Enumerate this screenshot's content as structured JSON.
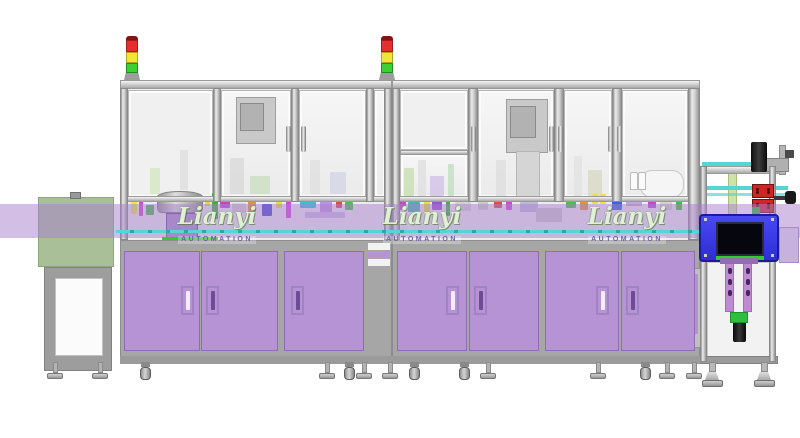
{
  "scene": {
    "title": "Automated assembly line - CAD side elevation"
  },
  "watermark": {
    "brand": "Lianyi",
    "subtitle": "AUTOMATION"
  },
  "colors": {
    "band": "rgba(167,128,205,0.5)",
    "cabinetDoor": "#b593d4",
    "cabinetDoorBorder": "#8f6cb4",
    "handleSlotDark": "#6f4b96",
    "handleSlotLight": "#f4ecfa",
    "panel": "#f0f0f0",
    "green_box": "#a8bf98",
    "tower_red": "#e63030",
    "tower_yellow": "#f2e437",
    "tower_green": "#3ecf35",
    "button_red": "#ee2222",
    "blue_box": "#3a3aee",
    "conveyor_cyan": "#55d6d2",
    "bright_green": "#2ecc2e",
    "cabinet_base": "#a6a6a6"
  },
  "signal_towers": [
    {
      "x": 126
    },
    {
      "x": 381
    }
  ],
  "parts": [
    {
      "x": 150,
      "y": 168,
      "w": 10,
      "h": 26,
      "c": "#d8e8c8"
    },
    {
      "x": 180,
      "y": 150,
      "w": 8,
      "h": 40,
      "c": "#e0e0e0"
    },
    {
      "x": 230,
      "y": 158,
      "w": 14,
      "h": 36,
      "c": "#dcdcdc"
    },
    {
      "x": 250,
      "y": 176,
      "w": 20,
      "h": 18,
      "c": "#d0e0c8"
    },
    {
      "x": 310,
      "y": 160,
      "w": 10,
      "h": 34,
      "c": "#e2e2e2"
    },
    {
      "x": 330,
      "y": 172,
      "w": 16,
      "h": 22,
      "c": "#d8d8e8"
    },
    {
      "x": 131,
      "y": 200,
      "w": 6,
      "h": 14,
      "c": "#e8e840"
    },
    {
      "x": 139,
      "y": 196,
      "w": 4,
      "h": 20,
      "c": "#d040d0"
    },
    {
      "x": 146,
      "y": 205,
      "w": 8,
      "h": 10,
      "c": "#40b840"
    },
    {
      "x": 205,
      "y": 196,
      "w": 5,
      "h": 10,
      "c": "#e0e020"
    },
    {
      "x": 212,
      "y": 193,
      "w": 6,
      "h": 26,
      "c": "#30b030"
    },
    {
      "x": 220,
      "y": 200,
      "w": 10,
      "h": 8,
      "c": "#c040c0"
    },
    {
      "x": 232,
      "y": 203,
      "w": 14,
      "h": 10,
      "c": "#d0d0d0"
    },
    {
      "x": 248,
      "y": 198,
      "w": 8,
      "h": 14,
      "c": "#e09030"
    },
    {
      "x": 258,
      "y": 196,
      "w": 26,
      "h": 6,
      "c": "#b0b0e8"
    },
    {
      "x": 262,
      "y": 204,
      "w": 10,
      "h": 12,
      "c": "#4040d0"
    },
    {
      "x": 276,
      "y": 200,
      "w": 6,
      "h": 8,
      "c": "#e8e030"
    },
    {
      "x": 286,
      "y": 196,
      "w": 5,
      "h": 22,
      "c": "#d040d0"
    },
    {
      "x": 300,
      "y": 198,
      "w": 16,
      "h": 10,
      "c": "#30c0c0"
    },
    {
      "x": 320,
      "y": 200,
      "w": 12,
      "h": 14,
      "c": "#b890d8"
    },
    {
      "x": 305,
      "y": 212,
      "w": 40,
      "h": 6,
      "c": "#c8b8e0"
    },
    {
      "x": 336,
      "y": 196,
      "w": 6,
      "h": 12,
      "c": "#e04040"
    },
    {
      "x": 345,
      "y": 202,
      "w": 8,
      "h": 8,
      "c": "#40c040"
    },
    {
      "x": 404,
      "y": 168,
      "w": 10,
      "h": 28,
      "c": "#cde2b8"
    },
    {
      "x": 418,
      "y": 160,
      "w": 8,
      "h": 36,
      "c": "#e2e2e2"
    },
    {
      "x": 430,
      "y": 176,
      "w": 14,
      "h": 20,
      "c": "#d4c8e8"
    },
    {
      "x": 448,
      "y": 164,
      "w": 6,
      "h": 32,
      "c": "#c8e0c8"
    },
    {
      "x": 496,
      "y": 160,
      "w": 10,
      "h": 36,
      "c": "#e0e0e0"
    },
    {
      "x": 574,
      "y": 156,
      "w": 8,
      "h": 40,
      "c": "#e4e4e4"
    },
    {
      "x": 588,
      "y": 170,
      "w": 14,
      "h": 26,
      "c": "#dcdccc"
    },
    {
      "x": 398,
      "y": 198,
      "w": 8,
      "h": 12,
      "c": "#c040c0"
    },
    {
      "x": 408,
      "y": 202,
      "w": 12,
      "h": 10,
      "c": "#40b0b0"
    },
    {
      "x": 424,
      "y": 196,
      "w": 6,
      "h": 16,
      "c": "#e0e030"
    },
    {
      "x": 432,
      "y": 200,
      "w": 10,
      "h": 10,
      "c": "#9050c0"
    },
    {
      "x": 446,
      "y": 196,
      "w": 4,
      "h": 20,
      "c": "#30b030"
    },
    {
      "x": 455,
      "y": 202,
      "w": 16,
      "h": 9,
      "c": "#d0d0d0"
    },
    {
      "x": 478,
      "y": 198,
      "w": 10,
      "h": 12,
      "c": "#c8c8c8"
    },
    {
      "x": 494,
      "y": 200,
      "w": 8,
      "h": 8,
      "c": "#e04040"
    },
    {
      "x": 506,
      "y": 196,
      "w": 6,
      "h": 14,
      "c": "#d040d0"
    },
    {
      "x": 520,
      "y": 202,
      "w": 18,
      "h": 10,
      "c": "#b8b8d8"
    },
    {
      "x": 536,
      "y": 208,
      "w": 26,
      "h": 14,
      "c": "#c6c6c6"
    },
    {
      "x": 566,
      "y": 198,
      "w": 10,
      "h": 10,
      "c": "#40c040"
    },
    {
      "x": 580,
      "y": 196,
      "w": 8,
      "h": 14,
      "c": "#e09030"
    },
    {
      "x": 592,
      "y": 194,
      "w": 6,
      "h": 10,
      "c": "#f0e030"
    },
    {
      "x": 600,
      "y": 194,
      "w": 6,
      "h": 10,
      "c": "#f0e030"
    },
    {
      "x": 612,
      "y": 200,
      "w": 10,
      "h": 10,
      "c": "#3060d0"
    },
    {
      "x": 626,
      "y": 198,
      "w": 16,
      "h": 8,
      "c": "#c0a0d8"
    },
    {
      "x": 648,
      "y": 196,
      "w": 8,
      "h": 12,
      "c": "#c040c0"
    },
    {
      "x": 660,
      "y": 200,
      "w": 12,
      "h": 10,
      "c": "#d0d0d0"
    },
    {
      "x": 676,
      "y": 198,
      "w": 6,
      "h": 12,
      "c": "#30c030"
    }
  ],
  "feet": [
    {
      "type": "caster",
      "cx": 145
    },
    {
      "type": "foot",
      "cx": 327
    },
    {
      "type": "caster",
      "cx": 349
    },
    {
      "type": "foot",
      "cx": 364
    },
    {
      "type": "foot",
      "cx": 390
    },
    {
      "type": "caster",
      "cx": 414
    },
    {
      "type": "caster",
      "cx": 464
    },
    {
      "type": "foot",
      "cx": 488
    },
    {
      "type": "foot",
      "cx": 598
    },
    {
      "type": "caster",
      "cx": 645
    },
    {
      "type": "foot",
      "cx": 667
    },
    {
      "type": "foot",
      "cx": 694
    },
    {
      "type": "bigfoot",
      "cx": 712
    },
    {
      "type": "bigfoot",
      "cx": 764
    },
    {
      "type": "foot",
      "cx": 55
    },
    {
      "type": "foot",
      "cx": 100
    }
  ]
}
